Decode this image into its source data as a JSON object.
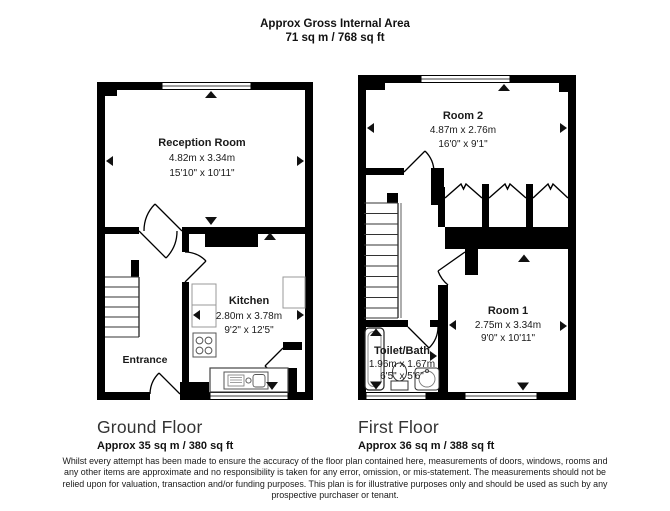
{
  "title": {
    "line1": "Approx Gross Internal Area",
    "line2": "71 sq m / 768 sq ft"
  },
  "ground_floor": {
    "name": "Ground Floor",
    "area": "Approx 35 sq m / 380 sq ft",
    "rooms": {
      "reception": {
        "name": "Reception Room",
        "metric": "4.82m x 3.34m",
        "imperial": "15'10\" x 10'11\""
      },
      "kitchen": {
        "name": "Kitchen",
        "metric": "2.80m x 3.78m",
        "imperial": "9'2\" x 12'5\""
      },
      "entrance": {
        "name": "Entrance"
      }
    }
  },
  "first_floor": {
    "name": "First Floor",
    "area": "Approx 36 sq m / 388 sq ft",
    "rooms": {
      "room2": {
        "name": "Room 2",
        "metric": "4.87m x 2.76m",
        "imperial": "16'0\" x 9'1\""
      },
      "room1": {
        "name": "Room 1",
        "metric": "2.75m x 3.34m",
        "imperial": "9'0\" x 10'11\""
      },
      "toilet_bath": {
        "name": "Toilet/Bath",
        "metric": "1.96m x 1.67m",
        "imperial": "6'5\" x 5'6\""
      }
    }
  },
  "disclaimer": {
    "line1": "Whilst every attempt has been made to ensure the accuracy of the floor plan contained here, measurements of doors, windows, rooms and",
    "line2": "any other items are approximate and no responsibility is taken for any error, omission, or mis-statement. The measurements should not be",
    "line3": "relied upon for valuation, transaction and/or funding purposes. This plan is for illustrative purposes only and should be used as such by any",
    "line4": "prospective purchaser or tenant."
  },
  "colors": {
    "wall": "#000000",
    "background": "#ffffff",
    "text": "#1a1a1a"
  }
}
